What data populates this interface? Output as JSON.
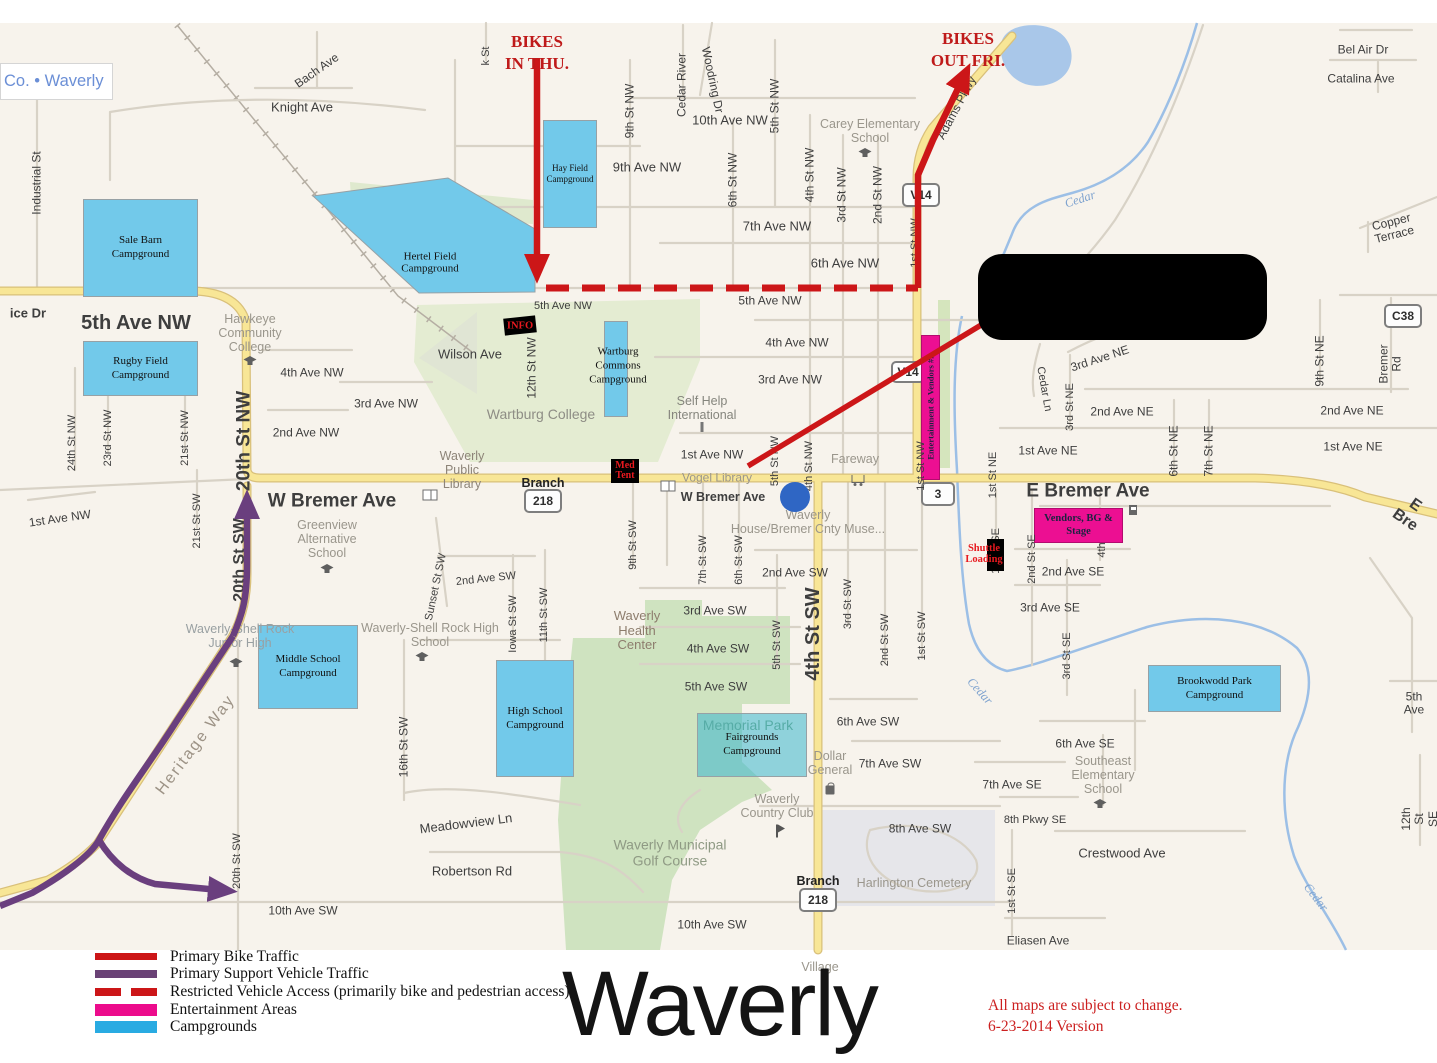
{
  "attribution": {
    "text": "Co. • Waverly"
  },
  "title": {
    "text": "Waverly"
  },
  "version": {
    "line1": "All maps are subject to change.",
    "line2": "6-23-2014 Version"
  },
  "annotations": {
    "bikes_in": "BIKES\nIN THU.",
    "bikes_out": "BIKES\nOUT FRI."
  },
  "markers": {
    "info": "INFO",
    "med_tent": "Med\nTent",
    "shuttle": "Shuttle\nLoading"
  },
  "colors": {
    "bike_route": "#cc1618",
    "support_route": "#6a3f7e",
    "restricted": "#cc1618",
    "entertainment": "#ec0f92",
    "campground": "#72c9ea",
    "legend_campground": "#29abe2",
    "road_major": "#f8e696",
    "water": "#9cbfe6"
  },
  "legend": {
    "items": [
      {
        "type": "line",
        "color": "#cc1618",
        "h": 7,
        "label": "Primary Bike Traffic"
      },
      {
        "type": "line",
        "color": "#6a4276",
        "h": 8,
        "label": "Primary Support Vehicle Traffic"
      },
      {
        "type": "dashed",
        "color": "#cc1618",
        "h": 8,
        "label": "Restricted Vehicle Access (primarily bike and pedestrian access)"
      },
      {
        "type": "fill",
        "color": "#ec0c8c",
        "h": 12,
        "label": "Entertainment Areas"
      },
      {
        "type": "fill",
        "color": "#29abe2",
        "h": 12,
        "label": "Campgrounds"
      }
    ]
  },
  "campgrounds": [
    {
      "t": "Sale Barn\nCampground",
      "x": 83,
      "y": 176,
      "w": 113,
      "h": 96
    },
    {
      "t": "Hay Field\nCampground",
      "x": 543,
      "y": 97,
      "w": 52,
      "h": 106,
      "fs": 9
    },
    {
      "t": "Rugby Field\nCampground",
      "x": 83,
      "y": 318,
      "w": 113,
      "h": 53
    },
    {
      "t": "Wartburg Commons\nCampground",
      "x": 604,
      "y": 298,
      "w": 22,
      "h": 94,
      "tx": 617,
      "ty": 342,
      "tlines": "Wartburg\nCommons\nCampground"
    },
    {
      "t": "Middle School\nCampground",
      "x": 258,
      "y": 602,
      "w": 98,
      "h": 82
    },
    {
      "t": "High School\nCampground",
      "x": 496,
      "y": 637,
      "w": 76,
      "h": 115
    },
    {
      "t": "Fairgrounds\nCampground",
      "x": 697,
      "y": 690,
      "w": 108,
      "h": 62,
      "ghost": true
    },
    {
      "t": "Brookwodd Park\nCampground",
      "x": 1148,
      "y": 642,
      "w": 131,
      "h": 45
    }
  ],
  "hertel": {
    "t": "Hertel Field\nCampground",
    "tx": 430,
    "ty": 240
  },
  "entertainment": [
    {
      "label": "Vendors, BG &\nStage",
      "x": 1034,
      "y": 485,
      "w": 87,
      "h": 33,
      "fs": 10.5
    },
    {
      "label": "Entertainment & Vendors #2",
      "x": 921,
      "y": 312,
      "w": 17,
      "h": 143,
      "rot": true,
      "fs": 8.5
    }
  ],
  "shields": [
    {
      "t": "218",
      "x": 543,
      "y": 478,
      "w": 34,
      "h": 20
    },
    {
      "t": "218",
      "x": 818,
      "y": 877,
      "w": 34,
      "h": 20
    },
    {
      "t": "3",
      "x": 938,
      "y": 471,
      "w": 30,
      "h": 20
    },
    {
      "t": "V14",
      "x": 921,
      "y": 172,
      "w": 34,
      "h": 20
    },
    {
      "t": "V14",
      "x": 908,
      "y": 349,
      "w": 30,
      "h": 18
    },
    {
      "t": "C38",
      "x": 1403,
      "y": 293,
      "w": 34,
      "h": 20
    }
  ],
  "street_labels": [
    {
      "t": "Knight Ave",
      "x": 302,
      "y": 85,
      "s": 13
    },
    {
      "t": "Bach Ave",
      "x": 317,
      "y": 48,
      "r": -35,
      "s": 12
    },
    {
      "t": "Industrial St",
      "x": 37,
      "y": 160,
      "r": -90,
      "s": 12
    },
    {
      "t": "ice Dr",
      "x": 28,
      "y": 291,
      "s": 13,
      "b": 1
    },
    {
      "t": "5th Ave NW",
      "x": 136,
      "y": 300,
      "s": 20,
      "b": 1
    },
    {
      "t": "k St",
      "x": 486,
      "y": 33,
      "r": -90,
      "s": 11
    },
    {
      "t": "9th St NW",
      "x": 630,
      "y": 88,
      "r": -90,
      "s": 12
    },
    {
      "t": "Cedar River",
      "x": 682,
      "y": 62,
      "r": -90,
      "s": 12
    },
    {
      "t": "Woodring Dr",
      "x": 712,
      "y": 57,
      "r": 78,
      "s": 12
    },
    {
      "t": "10th Ave NW",
      "x": 730,
      "y": 98,
      "s": 13
    },
    {
      "t": "5th St NW",
      "x": 775,
      "y": 83,
      "r": -90,
      "s": 12
    },
    {
      "t": "9th Ave NW",
      "x": 647,
      "y": 145,
      "s": 13
    },
    {
      "t": "6th St NW",
      "x": 733,
      "y": 157,
      "r": -90,
      "s": 12
    },
    {
      "t": "4th St NW",
      "x": 810,
      "y": 152,
      "r": -90,
      "s": 12
    },
    {
      "t": "3rd St NW",
      "x": 842,
      "y": 172,
      "r": -90,
      "s": 12
    },
    {
      "t": "2nd St NW",
      "x": 878,
      "y": 172,
      "r": -90,
      "s": 12
    },
    {
      "t": "7th Ave NW",
      "x": 777,
      "y": 204,
      "s": 13
    },
    {
      "t": "6th Ave NW",
      "x": 845,
      "y": 241,
      "s": 13
    },
    {
      "t": "5th Ave NW",
      "x": 563,
      "y": 283,
      "s": 11
    },
    {
      "t": "5th Ave NW",
      "x": 770,
      "y": 278,
      "s": 12
    },
    {
      "t": "1st St NW",
      "x": 915,
      "y": 220,
      "r": -90,
      "s": 11
    },
    {
      "t": "Adams Pkwy",
      "x": 957,
      "y": 85,
      "r": -62,
      "s": 12
    },
    {
      "t": "Bel Air Dr",
      "x": 1363,
      "y": 27,
      "s": 12
    },
    {
      "t": "Catalina Ave",
      "x": 1361,
      "y": 56,
      "s": 12
    },
    {
      "t": "Copper Terrace",
      "x": 1393,
      "y": 206,
      "r": -14,
      "s": 12
    },
    {
      "t": "Bremer Rd",
      "x": 1391,
      "y": 341,
      "r": -90,
      "s": 12
    },
    {
      "t": "9th St NE",
      "x": 1320,
      "y": 338,
      "r": -90,
      "s": 12
    },
    {
      "t": "4th Ave NW",
      "x": 312,
      "y": 350,
      "s": 12
    },
    {
      "t": "3rd Ave NW",
      "x": 386,
      "y": 381,
      "s": 12
    },
    {
      "t": "2nd Ave NW",
      "x": 306,
      "y": 410,
      "s": 12
    },
    {
      "t": "1st Ave NW",
      "x": 60,
      "y": 496,
      "r": -8,
      "s": 12
    },
    {
      "t": "24th St NW",
      "x": 72,
      "y": 420,
      "r": -90,
      "s": 11
    },
    {
      "t": "23rd St NW",
      "x": 108,
      "y": 415,
      "r": -90,
      "s": 11
    },
    {
      "t": "21st St NW",
      "x": 185,
      "y": 415,
      "r": -90,
      "s": 11
    },
    {
      "t": "21st St SW",
      "x": 197,
      "y": 498,
      "r": -90,
      "s": 11
    },
    {
      "t": "20th St NW",
      "x": 244,
      "y": 418,
      "r": -90,
      "s": 19,
      "b": 1
    },
    {
      "t": "20th St SW",
      "x": 240,
      "y": 537,
      "r": -90,
      "s": 16,
      "b": 1
    },
    {
      "t": "Wilson Ave",
      "x": 470,
      "y": 332,
      "s": 13
    },
    {
      "t": "12th St NW",
      "x": 532,
      "y": 345,
      "r": -90,
      "s": 12
    },
    {
      "t": "4th Ave NW",
      "x": 797,
      "y": 320,
      "s": 12
    },
    {
      "t": "3rd Ave NW",
      "x": 790,
      "y": 357,
      "s": 12
    },
    {
      "t": "1st Ave NW",
      "x": 712,
      "y": 432,
      "s": 12
    },
    {
      "t": "W Bremer Ave",
      "x": 332,
      "y": 478,
      "s": 19,
      "b": 1
    },
    {
      "t": "W Bremer Ave",
      "x": 723,
      "y": 474,
      "s": 12.5,
      "b": 1
    },
    {
      "t": "E Bremer Ave",
      "x": 1088,
      "y": 468,
      "s": 19,
      "b": 1
    },
    {
      "t": "E Bre",
      "x": 1410,
      "y": 490,
      "r": 35,
      "s": 16,
      "b": 1
    },
    {
      "t": "3rd Ave NE",
      "x": 1100,
      "y": 336,
      "r": -18,
      "s": 12
    },
    {
      "t": "Cedar Ln",
      "x": 1044,
      "y": 366,
      "r": 80,
      "s": 11
    },
    {
      "t": "3rd St NE",
      "x": 1070,
      "y": 384,
      "r": -90,
      "s": 11
    },
    {
      "t": "2nd Ave NE",
      "x": 1122,
      "y": 389,
      "s": 12
    },
    {
      "t": "2nd Ave NE",
      "x": 1352,
      "y": 388,
      "s": 12
    },
    {
      "t": "1st Ave NE",
      "x": 1048,
      "y": 428,
      "s": 12
    },
    {
      "t": "1st Ave NE",
      "x": 1353,
      "y": 424,
      "s": 12
    },
    {
      "t": "1st St NE",
      "x": 993,
      "y": 452,
      "r": -90,
      "s": 11
    },
    {
      "t": "6th St NE",
      "x": 1174,
      "y": 428,
      "r": -90,
      "s": 12
    },
    {
      "t": "7th St NE",
      "x": 1209,
      "y": 428,
      "r": -90,
      "s": 12
    },
    {
      "t": "5th St NW",
      "x": 775,
      "y": 438,
      "r": -90,
      "s": 11
    },
    {
      "t": "4th St NW",
      "x": 809,
      "y": 443,
      "r": -90,
      "s": 11
    },
    {
      "t": "1st St NW",
      "x": 921,
      "y": 443,
      "r": -90,
      "s": 11
    },
    {
      "t": "2nd Ave SW",
      "x": 795,
      "y": 550,
      "s": 12
    },
    {
      "t": "2nd Ave SW",
      "x": 486,
      "y": 556,
      "r": -6,
      "s": 11
    },
    {
      "t": "3rd Ave SW",
      "x": 715,
      "y": 588,
      "s": 12
    },
    {
      "t": "4th Ave SW",
      "x": 718,
      "y": 626,
      "s": 12
    },
    {
      "t": "5th Ave SW",
      "x": 716,
      "y": 664,
      "s": 12
    },
    {
      "t": "6th Ave SW",
      "x": 868,
      "y": 699,
      "s": 12
    },
    {
      "t": "7th Ave SW",
      "x": 890,
      "y": 741,
      "s": 12
    },
    {
      "t": "8th Ave SW",
      "x": 920,
      "y": 806,
      "s": 12
    },
    {
      "t": "10th Ave SW",
      "x": 303,
      "y": 888,
      "s": 12
    },
    {
      "t": "10th Ave SW",
      "x": 712,
      "y": 902,
      "s": 12
    },
    {
      "t": "9th St SW",
      "x": 633,
      "y": 522,
      "r": -90,
      "s": 11
    },
    {
      "t": "7th St SW",
      "x": 703,
      "y": 537,
      "r": -90,
      "s": 11
    },
    {
      "t": "6th St SW",
      "x": 739,
      "y": 537,
      "r": -90,
      "s": 11
    },
    {
      "t": "5th St SW",
      "x": 777,
      "y": 622,
      "r": -90,
      "s": 11
    },
    {
      "t": "4th St SW",
      "x": 813,
      "y": 611,
      "r": -90,
      "s": 20,
      "b": 1
    },
    {
      "t": "3rd St SW",
      "x": 848,
      "y": 581,
      "r": -90,
      "s": 11
    },
    {
      "t": "2nd St SW",
      "x": 885,
      "y": 617,
      "r": -90,
      "s": 11
    },
    {
      "t": "1st St SW",
      "x": 922,
      "y": 613,
      "r": -90,
      "s": 11
    },
    {
      "t": "1st St SE",
      "x": 996,
      "y": 528,
      "r": -90,
      "s": 11
    },
    {
      "t": "2nd St SE",
      "x": 1032,
      "y": 536,
      "r": -90,
      "s": 11
    },
    {
      "t": "4th",
      "x": 1102,
      "y": 527,
      "r": -90,
      "s": 11
    },
    {
      "t": "2nd Ave SE",
      "x": 1073,
      "y": 549,
      "s": 12
    },
    {
      "t": "3rd Ave SE",
      "x": 1050,
      "y": 585,
      "s": 12
    },
    {
      "t": "3rd St SE",
      "x": 1067,
      "y": 633,
      "r": -90,
      "s": 11
    },
    {
      "t": "6th Ave SE",
      "x": 1085,
      "y": 721,
      "s": 12
    },
    {
      "t": "7th Ave SE",
      "x": 1012,
      "y": 762,
      "s": 12
    },
    {
      "t": "8th Pkwy SE",
      "x": 1035,
      "y": 797,
      "s": 11
    },
    {
      "t": "Crestwood Ave",
      "x": 1122,
      "y": 831,
      "s": 13
    },
    {
      "t": "12th St SE",
      "x": 1420,
      "y": 796,
      "r": -90,
      "s": 12
    },
    {
      "t": "5th Ave",
      "x": 1414,
      "y": 681,
      "s": 12
    },
    {
      "t": "1st St SE",
      "x": 1012,
      "y": 868,
      "r": -90,
      "s": 11
    },
    {
      "t": "Eliasen Ave",
      "x": 1038,
      "y": 918,
      "s": 12
    },
    {
      "t": "Heritage Way",
      "x": 196,
      "y": 722,
      "r": -53,
      "s": 16,
      "c": "#9d9386",
      "ls": 2
    },
    {
      "t": "16th St SW",
      "x": 404,
      "y": 724,
      "r": -90,
      "s": 12
    },
    {
      "t": "Meadowview Ln",
      "x": 466,
      "y": 801,
      "r": -7,
      "s": 13
    },
    {
      "t": "Robertson Rd",
      "x": 472,
      "y": 849,
      "s": 13
    },
    {
      "t": "Iowa St SW",
      "x": 513,
      "y": 601,
      "r": -90,
      "s": 11
    },
    {
      "t": "11th St SW",
      "x": 544,
      "y": 592,
      "r": -90,
      "s": 11
    },
    {
      "t": "Sunset St SW",
      "x": 436,
      "y": 564,
      "r": -78,
      "s": 11
    },
    {
      "t": "20th St SW",
      "x": 237,
      "y": 838,
      "r": -90,
      "s": 11
    },
    {
      "t": "Branch",
      "x": 543,
      "y": 460,
      "s": 12.5,
      "b": 1,
      "c": "#222222"
    },
    {
      "t": "Branch",
      "x": 818,
      "y": 858,
      "s": 12.5,
      "b": 1,
      "c": "#222222"
    }
  ],
  "poi_labels": [
    {
      "t": "Hawkeye\nCommunity\nCollege",
      "x": 250,
      "y": 310,
      "s": 12.5
    },
    {
      "t": "Carey Elementary\nSchool",
      "x": 870,
      "y": 108,
      "s": 12.5
    },
    {
      "t": "Wartburg College",
      "x": 541,
      "y": 392,
      "s": 14,
      "c": "#8e8d85"
    },
    {
      "t": "Waverly\nPublic\nLibrary",
      "x": 462,
      "y": 447,
      "s": 12.5,
      "c": "#8d8478"
    },
    {
      "t": "Self Help\nInternational",
      "x": 702,
      "y": 385,
      "s": 12.5,
      "c": "#85857d"
    },
    {
      "t": "Vogel Library",
      "x": 717,
      "y": 455,
      "s": 12
    },
    {
      "t": "Waverly\nHouse/Bremer Cnty Muse...",
      "x": 808,
      "y": 499,
      "s": 12.5
    },
    {
      "t": "Fareway",
      "x": 855,
      "y": 436,
      "s": 12.5
    },
    {
      "t": "Greenview\nAlternative\nSchool",
      "x": 327,
      "y": 516,
      "s": 12.5
    },
    {
      "t": "Waverly-Shell Rock\nJunior High",
      "x": 240,
      "y": 613,
      "s": 12.5,
      "c": "#99a0a2"
    },
    {
      "t": "Waverly-Shell Rock High\nSchool",
      "x": 430,
      "y": 612,
      "s": 12.5
    },
    {
      "t": "Waverly\nHealth\nCenter",
      "x": 637,
      "y": 608,
      "s": 13,
      "c": "#8d7d6d"
    },
    {
      "t": "Memorial Park",
      "x": 748,
      "y": 703,
      "s": 14,
      "c": "#79a077",
      "z": 1
    },
    {
      "t": "Dollar\nGeneral",
      "x": 830,
      "y": 740,
      "s": 12.5
    },
    {
      "t": "Waverly\nCountry Club",
      "x": 777,
      "y": 783,
      "s": 12.5
    },
    {
      "t": "Waverly Municipal\nGolf Course",
      "x": 670,
      "y": 830,
      "s": 14,
      "c": "#8f9a84"
    },
    {
      "t": "Harlington Cemetery",
      "x": 914,
      "y": 860,
      "s": 12.5
    },
    {
      "t": "Village",
      "x": 820,
      "y": 944,
      "s": 12.5
    },
    {
      "t": "Southeast\nElementary\nSchool",
      "x": 1103,
      "y": 752,
      "s": 12.5
    }
  ],
  "water_labels": [
    {
      "t": "Cedar",
      "x": 1080,
      "y": 176,
      "r": -18,
      "s": 12.5
    },
    {
      "t": "Cedar",
      "x": 980,
      "y": 668,
      "r": 48,
      "s": 12.5
    },
    {
      "t": "Cedar",
      "x": 1316,
      "y": 874,
      "r": 52,
      "s": 12.5
    }
  ],
  "icons": [
    {
      "k": "school",
      "x": 250,
      "y": 338
    },
    {
      "k": "school",
      "x": 865,
      "y": 130
    },
    {
      "k": "school",
      "x": 327,
      "y": 546
    },
    {
      "k": "school",
      "x": 236,
      "y": 640
    },
    {
      "k": "school",
      "x": 422,
      "y": 634
    },
    {
      "k": "school",
      "x": 1100,
      "y": 781
    },
    {
      "k": "book",
      "x": 430,
      "y": 472
    },
    {
      "k": "book",
      "x": 668,
      "y": 463
    },
    {
      "k": "cart",
      "x": 858,
      "y": 456
    },
    {
      "k": "bag",
      "x": 830,
      "y": 767
    },
    {
      "k": "gas",
      "x": 1133,
      "y": 487
    },
    {
      "k": "flag",
      "x": 777,
      "y": 808
    },
    {
      "k": "pillar",
      "x": 702,
      "y": 404
    }
  ]
}
